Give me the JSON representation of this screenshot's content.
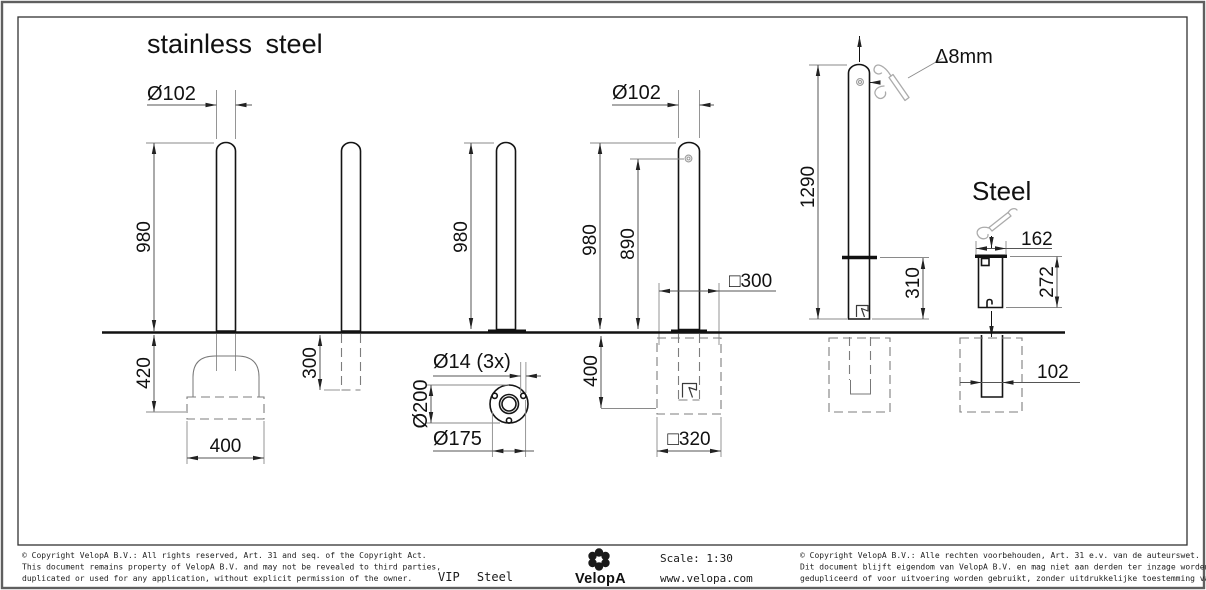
{
  "drawing": {
    "title_left": "stainless steel",
    "title_right": "Steel",
    "dims": {
      "b1_dia": "Ø102",
      "b1_height": "980",
      "b1_depth": "420",
      "b1_foundation_width": "400",
      "b2_depth": "300",
      "b3_height": "980",
      "flange_holes": "Ø14 (3x)",
      "flange_outer": "Ø200",
      "flange_bolt_circle": "Ø175",
      "b4_dia": "Ø102",
      "b4_height": "980",
      "b4_lock_height": "890",
      "b4_pit_width": "□300",
      "b4_pit_depth": "400",
      "b4_foundation_width": "□320",
      "b5_length": "1290",
      "b5_below_collar": "310",
      "b5_key": "Δ8mm",
      "steel_flange_width": "162",
      "steel_sleeve_depth": "272",
      "steel_tube_dia": "102"
    }
  },
  "footer": {
    "copyright_en": [
      "© Copyright VelopA B.V.: All rights reserved, Art. 31 and seq. of the Copyright Act.",
      "This document remains property of VelopA B.V. and may not be revealed to third parties,",
      "duplicated or used for any application, without explicit permission of the owner."
    ],
    "product": "VIP Steel",
    "brand": "VelopA",
    "scale": "Scale: 1:30",
    "website": "www.velopa.com",
    "copyright_nl": [
      "© Copyright VelopA B.V.: Alle rechten voorbehouden, Art. 31 e.v. van de auteurswet.",
      "Dit document blijft eigendom van VelopA B.V. en mag niet aan derden ter inzage worden gegeven,",
      "gedupliceerd of voor uitvoering worden gebruikt, zonder uitdrukkelijke toestemming van de eigenaar."
    ]
  }
}
